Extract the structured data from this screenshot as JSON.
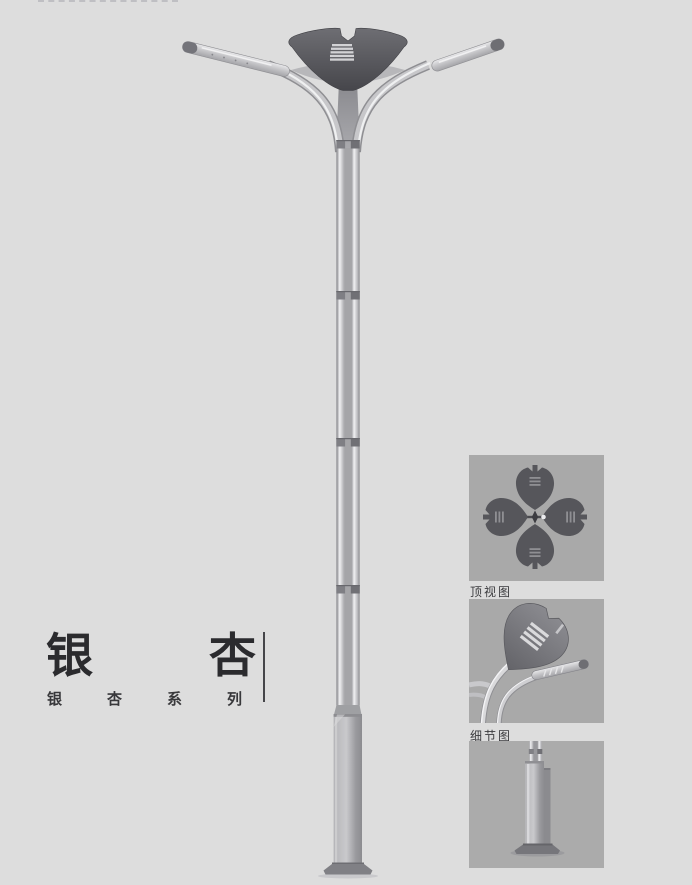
{
  "title_block": {
    "title": "银杏",
    "subtitle": "银杏系列"
  },
  "panels": {
    "top_view_caption": "顶视图",
    "detail_view_caption": "细节图"
  },
  "main_render": {
    "subject": "ginkgo-double-arm-street-lamp"
  },
  "colors": {
    "page_bg": "#dddddd",
    "panel_bg": "#a9a9a9",
    "leaf_dark": "#56565b",
    "metal_light": "#e9e9eb",
    "metal_mid": "#b2b2b5",
    "title_text": "#2b2b2e"
  }
}
